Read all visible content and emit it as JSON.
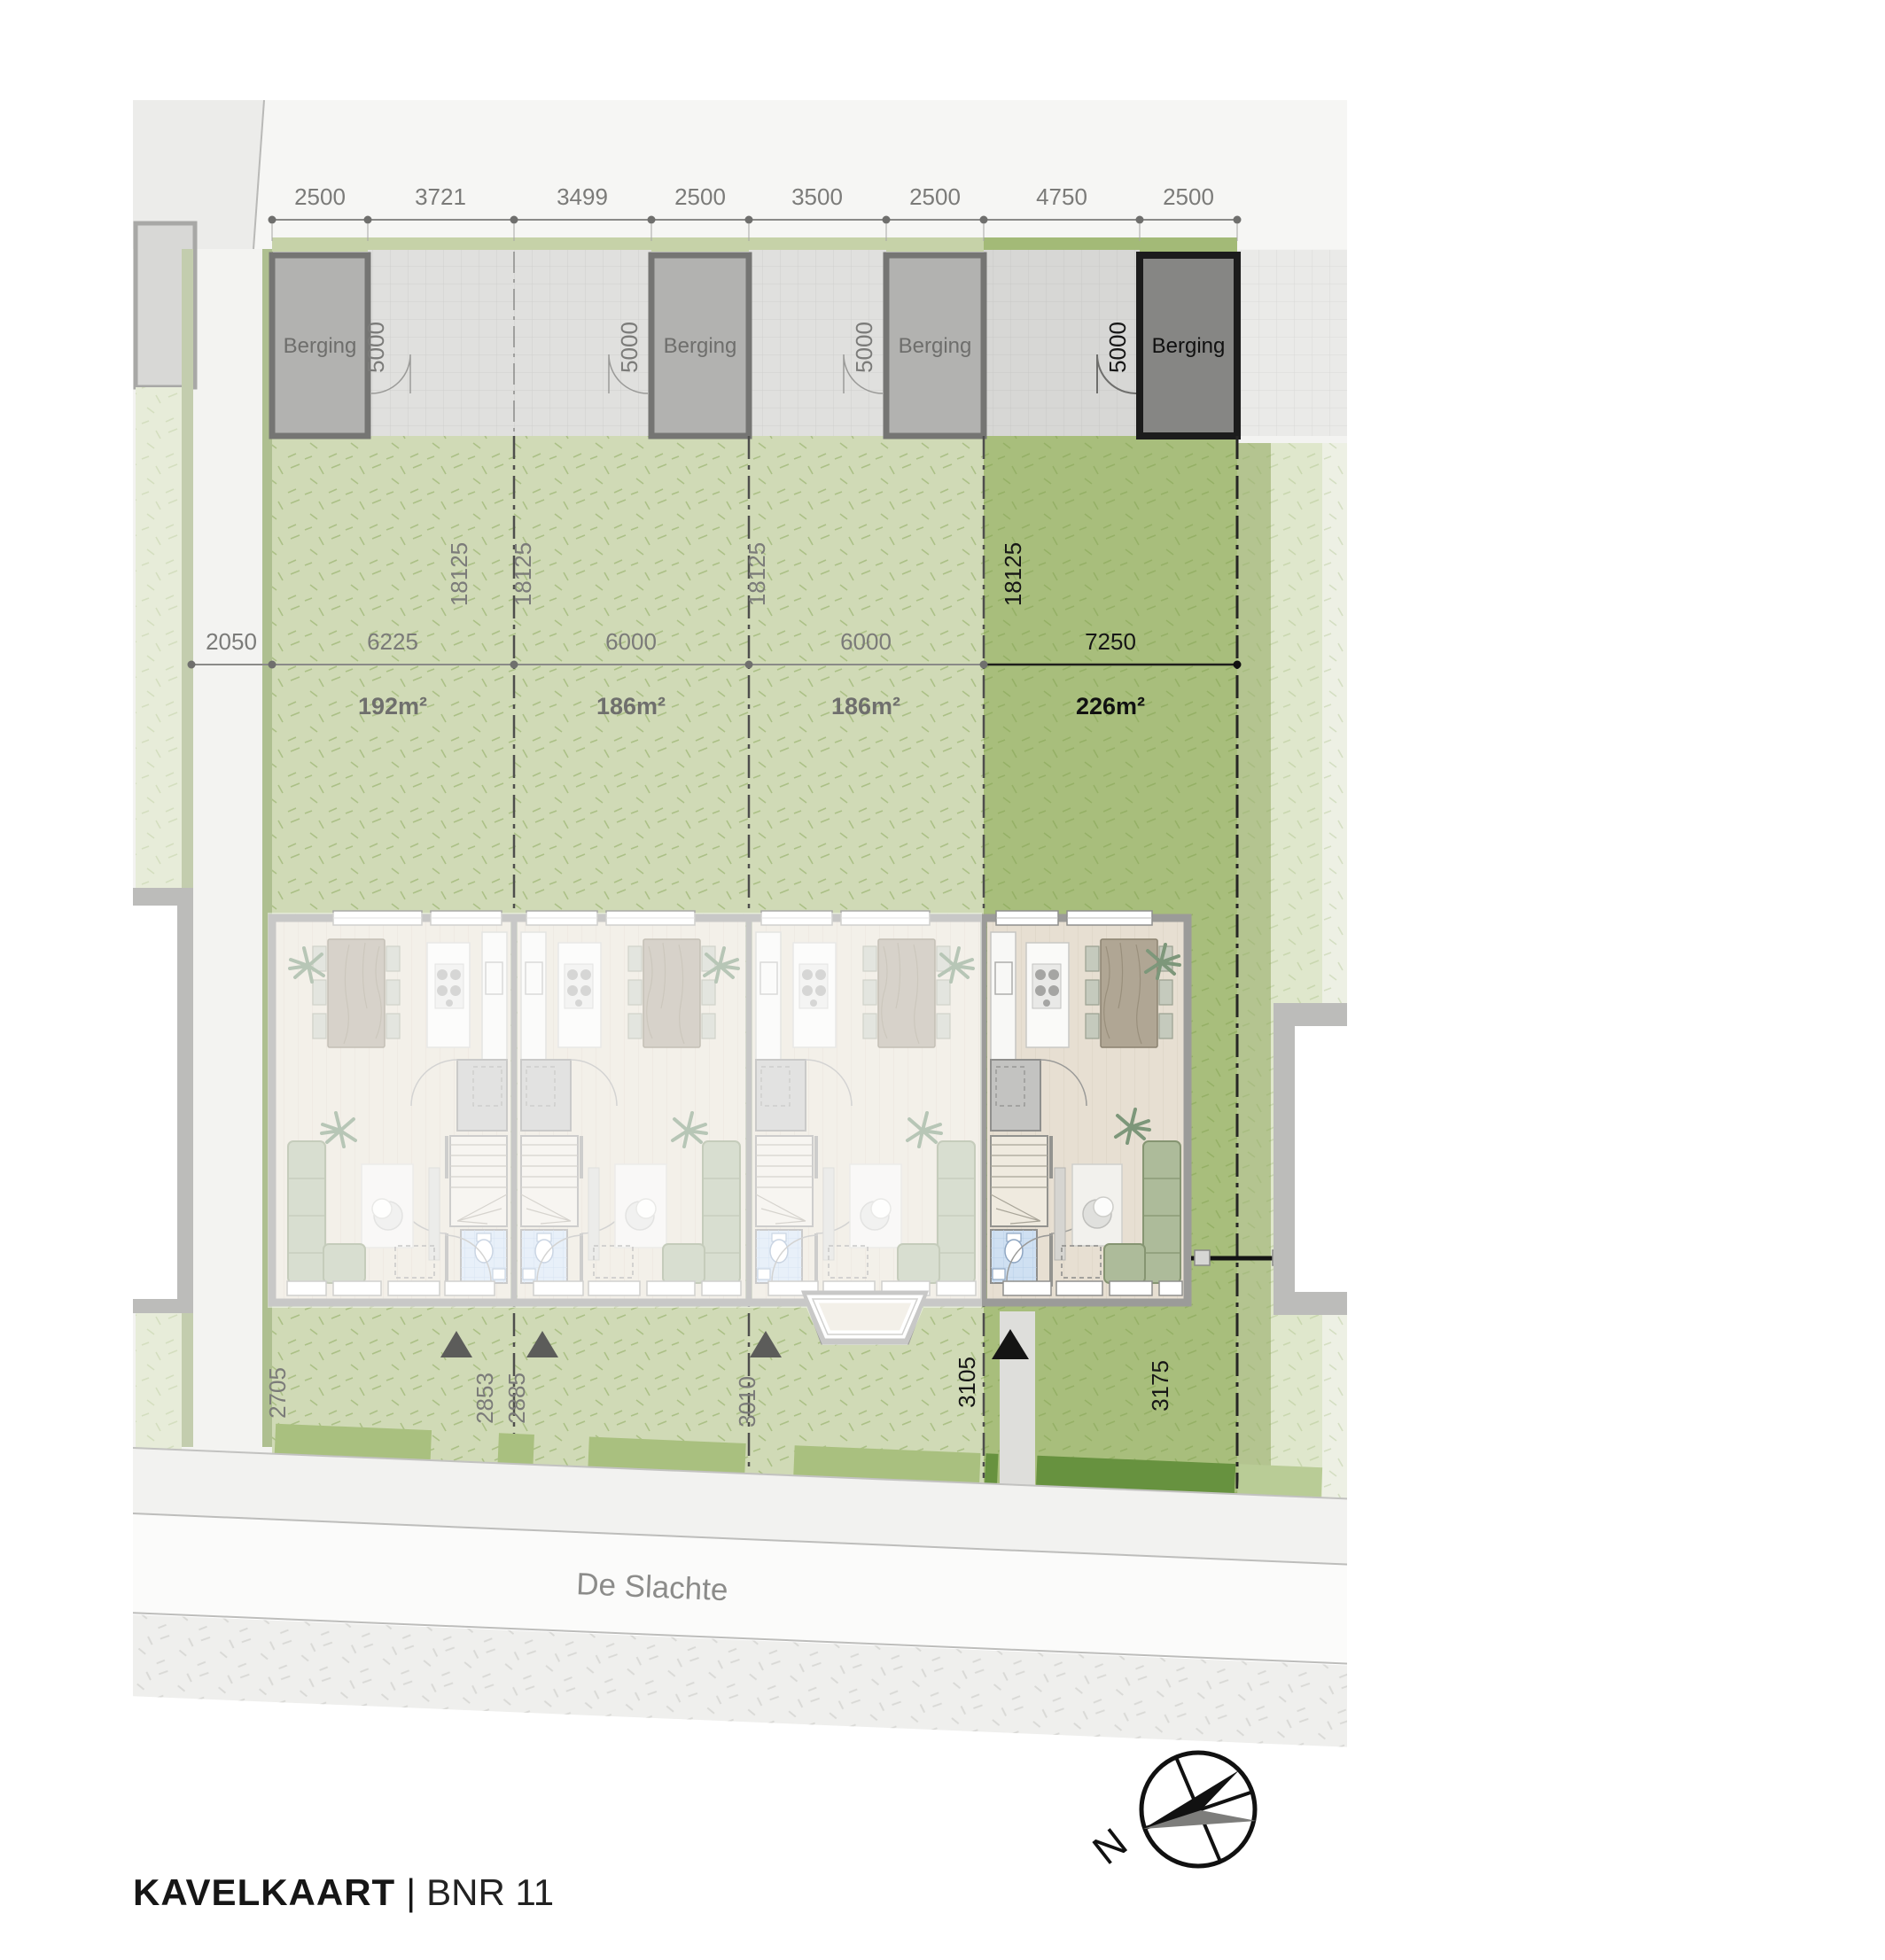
{
  "title": {
    "main": "KAVELKAART",
    "separator": "|",
    "plot": "BNR 11"
  },
  "street": {
    "name": "De Slachte"
  },
  "compass": {
    "label": "N"
  },
  "berging": {
    "label": "Berging",
    "depth": "5000"
  },
  "dims": {
    "top": [
      "2500",
      "3721",
      "3499",
      "2500",
      "3500",
      "2500",
      "4750",
      "2500"
    ],
    "path_width": "2050",
    "front": [
      "2705",
      "2853",
      "2885",
      "3010",
      "3105",
      "3175"
    ]
  },
  "plots": [
    {
      "width": "6225",
      "depth": "18125",
      "area": "192m²",
      "highlighted": false
    },
    {
      "width": "6000",
      "depth": "18125",
      "area": "186m²",
      "highlighted": false
    },
    {
      "width": "6000",
      "depth": "18125",
      "area": "186m²",
      "highlighted": false
    },
    {
      "width": "7250",
      "depth": "18125",
      "area": "226m²",
      "highlighted": true
    }
  ]
}
